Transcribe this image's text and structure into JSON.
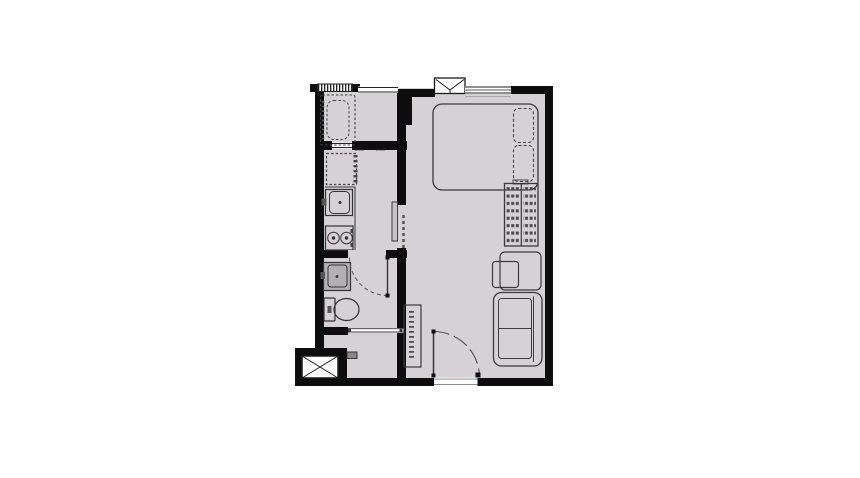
{
  "page": {
    "background_color": "#ffffff"
  },
  "floor_plan": {
    "kind": "studio-apartment-floor-plan",
    "colors": {
      "wall": "#0d0d0d",
      "floor": "#d6d1d4",
      "furniture_outline": "#3b3b3b",
      "fixture_fill": "#b3afb2",
      "door_panel": "#c8c3c6",
      "white": "#ffffff"
    },
    "annotations": {
      "dim_label_left": "xxx",
      "dim_label_right": "xxx"
    },
    "rooms": [
      {
        "name": "balcony"
      },
      {
        "name": "kitchen"
      },
      {
        "name": "bathroom"
      },
      {
        "name": "storage-nook"
      },
      {
        "name": "living-bedroom"
      },
      {
        "name": "entrance-hall"
      },
      {
        "name": "service-shaft"
      }
    ],
    "fixtures": [
      "balcony-railing",
      "washing-machine",
      "refrigerator-space",
      "kitchen-sink",
      "two-burner-stove",
      "sliding-door",
      "bathroom-basin",
      "toilet",
      "bathroom-door",
      "service-pipe",
      "shoe-cabinet",
      "entrance-door",
      "air-conditioner-ledge",
      "bedroom-window",
      "double-bed",
      "pillow",
      "wardrobe",
      "desk",
      "chair",
      "sofa",
      "shaft-cross"
    ]
  }
}
